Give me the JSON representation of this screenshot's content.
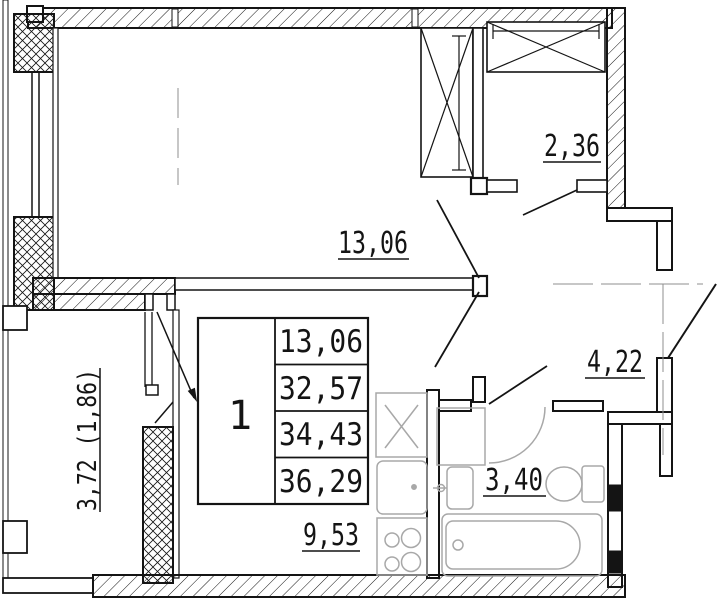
{
  "plan_title": "one-room apartment floor plan",
  "rooms": {
    "living": {
      "area": "13,06"
    },
    "closet": {
      "area": "2,36"
    },
    "hallway": {
      "area": "4,22"
    },
    "bathroom": {
      "area": "3,40"
    },
    "kitchen": {
      "area": "9,53"
    },
    "balcony": {
      "area": "3,72 (1,86)"
    }
  },
  "stamp": {
    "room_count": "1",
    "values": [
      "13,06",
      "32,57",
      "34,43",
      "36,29"
    ]
  },
  "colors": {
    "wall": "#141414",
    "fixture": "#a8a8a8",
    "centerline": "#8f8f8f",
    "background": "#ffffff"
  }
}
